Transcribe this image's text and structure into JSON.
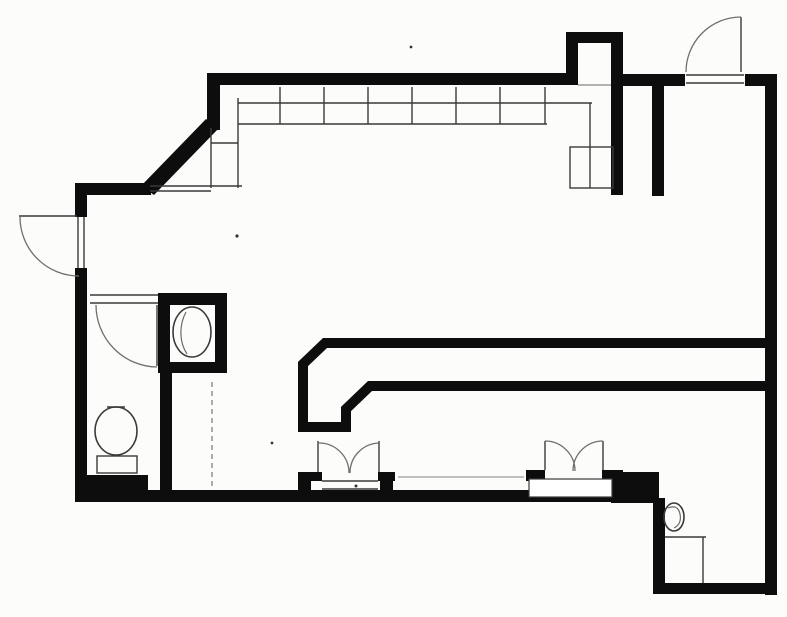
{
  "document": {
    "type": "scanned-floor-plan",
    "background_color": "#fcfcfa",
    "ink_color": "#0d0d0d",
    "thin_line_color": "#3a3a3a",
    "faint_line_color": "#9a9a9a",
    "arc_color": "#6f6f6f",
    "canvas": {
      "width": 787,
      "height": 617
    }
  },
  "floor_plan": {
    "filled_walls": [
      {
        "name": "top-left-corner-wall",
        "x": 207,
        "y": 73,
        "w": 13,
        "h": 57
      },
      {
        "name": "top-wall-left-section",
        "x": 207,
        "y": 73,
        "w": 371,
        "h": 12
      },
      {
        "name": "alcove-left-wall",
        "x": 566,
        "y": 32,
        "w": 12,
        "h": 53
      },
      {
        "name": "alcove-top-wall",
        "x": 566,
        "y": 32,
        "w": 57,
        "h": 11
      },
      {
        "name": "alcove-right-wall",
        "x": 611,
        "y": 32,
        "w": 12,
        "h": 163
      },
      {
        "name": "top-wall-mid-right-section",
        "x": 623,
        "y": 74,
        "w": 62,
        "h": 12
      },
      {
        "name": "top-wall-right-section",
        "x": 745,
        "y": 74,
        "w": 32,
        "h": 12
      },
      {
        "name": "right-outer-wall",
        "x": 765,
        "y": 74,
        "w": 12,
        "h": 521
      },
      {
        "name": "partition-stub-wall",
        "x": 652,
        "y": 78,
        "w": 12,
        "h": 118
      },
      {
        "name": "left-wall-upper",
        "x": 75,
        "y": 183,
        "w": 12,
        "h": 34
      },
      {
        "name": "left-corner-wall",
        "x": 75,
        "y": 183,
        "w": 76,
        "h": 12
      },
      {
        "name": "left-wall-lower",
        "x": 75,
        "y": 268,
        "w": 12,
        "h": 234
      },
      {
        "name": "bottom-outer-wall",
        "x": 75,
        "y": 490,
        "w": 584,
        "h": 12
      },
      {
        "name": "bottom-wall-thick-block-left",
        "x": 75,
        "y": 475,
        "w": 73,
        "h": 27
      },
      {
        "name": "bottom-wall-thick-block-right",
        "x": 611,
        "y": 472,
        "w": 48,
        "h": 31
      },
      {
        "name": "step-down-wall",
        "x": 653,
        "y": 498,
        "w": 12,
        "h": 90
      },
      {
        "name": "bottom-wall-right-section",
        "x": 653,
        "y": 583,
        "w": 124,
        "h": 11
      },
      {
        "name": "closet-top-wall",
        "x": 158,
        "y": 293,
        "w": 69,
        "h": 12
      },
      {
        "name": "closet-left-wall",
        "x": 158,
        "y": 303,
        "w": 12,
        "h": 70
      },
      {
        "name": "closet-right-wall",
        "x": 215,
        "y": 293,
        "w": 12,
        "h": 80
      },
      {
        "name": "closet-bottom-wall",
        "x": 158,
        "y": 362,
        "w": 69,
        "h": 11
      },
      {
        "name": "wc-right-wall",
        "x": 160,
        "y": 373,
        "w": 12,
        "h": 119
      },
      {
        "name": "entry1-pilaster-left",
        "x": 298,
        "y": 472,
        "w": 13,
        "h": 30
      },
      {
        "name": "entry1-jamb-stub-left",
        "x": 298,
        "y": 472,
        "w": 24,
        "h": 9
      },
      {
        "name": "entry1-pilaster-right",
        "x": 380,
        "y": 472,
        "w": 13,
        "h": 30
      },
      {
        "name": "entry1-jamb-stub-right",
        "x": 378,
        "y": 472,
        "w": 17,
        "h": 9
      },
      {
        "name": "entry2-jamb-stub-left",
        "x": 526,
        "y": 470,
        "w": 19,
        "h": 11
      },
      {
        "name": "entry2-jamb-stub-right",
        "x": 602,
        "y": 470,
        "w": 21,
        "h": 11
      }
    ],
    "wall_polygons": [
      {
        "name": "diagonal-wall",
        "points": "206,119 219,128 154,195 141,186"
      }
    ],
    "wall_paths": [
      {
        "name": "service-corridor-wall",
        "d": "M 772 343 L 325 343 L 303 364 L 303 427 L 346 427 L 346 409 L 370 386 L 772 386",
        "stroke_width": 10
      }
    ],
    "white_overlays": [
      {
        "name": "entry2-threshold",
        "x": 529,
        "y": 479,
        "w": 83,
        "h": 18
      }
    ],
    "outline_rects": [
      {
        "name": "counter-end-equipment-box",
        "x": 570,
        "y": 147,
        "w": 43,
        "h": 41
      },
      {
        "name": "toilet-tank",
        "x": 97,
        "y": 456,
        "w": 40,
        "h": 17
      }
    ],
    "thin_lines": [
      {
        "name": "counter-front-edge",
        "x1": 238,
        "y1": 103,
        "x2": 592,
        "y2": 103
      },
      {
        "name": "counter-second-edge",
        "x1": 238,
        "y1": 124,
        "x2": 547,
        "y2": 124
      },
      {
        "name": "counter-divider-1",
        "x1": 280,
        "y1": 87,
        "x2": 280,
        "y2": 124
      },
      {
        "name": "counter-divider-2",
        "x1": 324,
        "y1": 87,
        "x2": 324,
        "y2": 124
      },
      {
        "name": "counter-divider-3",
        "x1": 368,
        "y1": 87,
        "x2": 368,
        "y2": 124
      },
      {
        "name": "counter-divider-4",
        "x1": 412,
        "y1": 87,
        "x2": 412,
        "y2": 124
      },
      {
        "name": "counter-divider-5",
        "x1": 456,
        "y1": 87,
        "x2": 456,
        "y2": 124
      },
      {
        "name": "counter-divider-6",
        "x1": 500,
        "y1": 87,
        "x2": 500,
        "y2": 124
      },
      {
        "name": "counter-divider-7",
        "x1": 545,
        "y1": 87,
        "x2": 545,
        "y2": 124
      },
      {
        "name": "counter-left-end-outer",
        "x1": 238,
        "y1": 98,
        "x2": 238,
        "y2": 188
      },
      {
        "name": "counter-left-end-inner",
        "x1": 211,
        "y1": 128,
        "x2": 211,
        "y2": 188
      },
      {
        "name": "counter-left-end-shelf",
        "x1": 211,
        "y1": 143,
        "x2": 238,
        "y2": 143
      },
      {
        "name": "counter-left-end-base",
        "x1": 150,
        "y1": 186,
        "x2": 242,
        "y2": 186
      },
      {
        "name": "sill-line-under-diagonal",
        "x1": 150,
        "y1": 191,
        "x2": 211,
        "y2": 191
      },
      {
        "name": "counter-right-end-edge",
        "x1": 590,
        "y1": 103,
        "x2": 590,
        "y2": 188
      },
      {
        "name": "wc-door-head-line",
        "x1": 90,
        "y1": 295,
        "x2": 158,
        "y2": 295
      },
      {
        "name": "wc-door-sill-line",
        "x1": 90,
        "y1": 303,
        "x2": 158,
        "y2": 303
      },
      {
        "name": "wc-door-leaf",
        "x1": 157,
        "y1": 305,
        "x2": 157,
        "y2": 366
      },
      {
        "name": "left-door-jamb-outer",
        "x1": 78,
        "y1": 217,
        "x2": 78,
        "y2": 268
      },
      {
        "name": "left-door-jamb-inner",
        "x1": 84,
        "y1": 217,
        "x2": 84,
        "y2": 268
      },
      {
        "name": "left-door-leaf",
        "x1": 19,
        "y1": 216,
        "x2": 77,
        "y2": 216
      },
      {
        "name": "top-door-sill-outer",
        "x1": 686,
        "y1": 75,
        "x2": 744,
        "y2": 75
      },
      {
        "name": "top-door-sill-inner",
        "x1": 686,
        "y1": 83,
        "x2": 744,
        "y2": 83
      },
      {
        "name": "top-door-leaf",
        "x1": 741,
        "y1": 17,
        "x2": 741,
        "y2": 72
      },
      {
        "name": "alcove-mouth-line",
        "x1": 578,
        "y1": 85,
        "x2": 611,
        "y2": 85,
        "color": "#9a9a9a"
      },
      {
        "name": "entry1-threshold-outer",
        "x1": 322,
        "y1": 481,
        "x2": 378,
        "y2": 481
      },
      {
        "name": "entry1-threshold-inner",
        "x1": 322,
        "y1": 489,
        "x2": 378,
        "y2": 489
      },
      {
        "name": "entry1-door-leaf-left",
        "x1": 318,
        "y1": 441,
        "x2": 318,
        "y2": 472
      },
      {
        "name": "entry1-door-leaf-right",
        "x1": 379,
        "y1": 441,
        "x2": 379,
        "y2": 472
      },
      {
        "name": "entry2-door-leaf-left",
        "x1": 545,
        "y1": 441,
        "x2": 545,
        "y2": 470
      },
      {
        "name": "entry2-door-leaf-right",
        "x1": 603,
        "y1": 441,
        "x2": 603,
        "y2": 470
      },
      {
        "name": "curb-line",
        "x1": 398,
        "y1": 477,
        "x2": 524,
        "y2": 477,
        "color": "#ababab"
      },
      {
        "name": "hidden-edge-dashed",
        "x1": 212,
        "y1": 382,
        "x2": 212,
        "y2": 488,
        "color": "#8a8a8a",
        "dashed": true
      },
      {
        "name": "corner-stall-line-h",
        "x1": 665,
        "y1": 537,
        "x2": 706,
        "y2": 537
      },
      {
        "name": "corner-stall-line-v",
        "x1": 703,
        "y1": 537,
        "x2": 703,
        "y2": 583
      },
      {
        "name": "toilet-top-tick",
        "x1": 107,
        "y1": 407,
        "x2": 125,
        "y2": 407
      }
    ],
    "ellipses": [
      {
        "name": "toilet-bowl",
        "cx": 116,
        "cy": 431,
        "rx": 21,
        "ry": 24
      },
      {
        "name": "water-heater-tank",
        "cx": 192,
        "cy": 332,
        "rx": 19,
        "ry": 25
      },
      {
        "name": "corner-fixture-bowl",
        "cx": 674,
        "cy": 517,
        "rx": 10,
        "ry": 14
      }
    ],
    "door_swing_arcs": [
      {
        "name": "left-exterior-door-swing",
        "d": "M 20 217 A 59 59 0 0 0 79 276"
      },
      {
        "name": "top-exterior-door-swing",
        "d": "M 741 17 A 55 55 0 0 0 686 72"
      },
      {
        "name": "wc-door-swing",
        "d": "M 96 305 A 62 62 0 0 0 157 367"
      },
      {
        "name": "entry1-door-swing-left",
        "d": "M 318 443 A 30 30 0 0 1 349 473"
      },
      {
        "name": "entry1-door-swing-right",
        "d": "M 379 443 A 30 30 0 0 0 350 473"
      },
      {
        "name": "entry2-door-swing-left",
        "d": "M 545 441 A 30 30 0 0 1 575 471"
      },
      {
        "name": "entry2-door-swing-right",
        "d": "M 603 441 A 30 30 0 0 0 573 471"
      }
    ],
    "detail_paths": [
      {
        "name": "water-heater-squiggle",
        "d": "M 186 312 C 179 325 179 342 187 354"
      },
      {
        "name": "corner-fixture-squiggle",
        "d": "M 668 508 q 10 -4 12 6 q 2 10 -6 14"
      }
    ],
    "scan_specks": [
      {
        "name": "scan-speck-1",
        "cx": 411,
        "cy": 47,
        "r": 1.4
      },
      {
        "name": "scan-speck-2",
        "cx": 237,
        "cy": 236,
        "r": 1.6
      },
      {
        "name": "scan-speck-3",
        "cx": 272,
        "cy": 443,
        "r": 1.4
      },
      {
        "name": "scan-speck-4",
        "cx": 356,
        "cy": 486,
        "r": 1.5
      }
    ]
  }
}
